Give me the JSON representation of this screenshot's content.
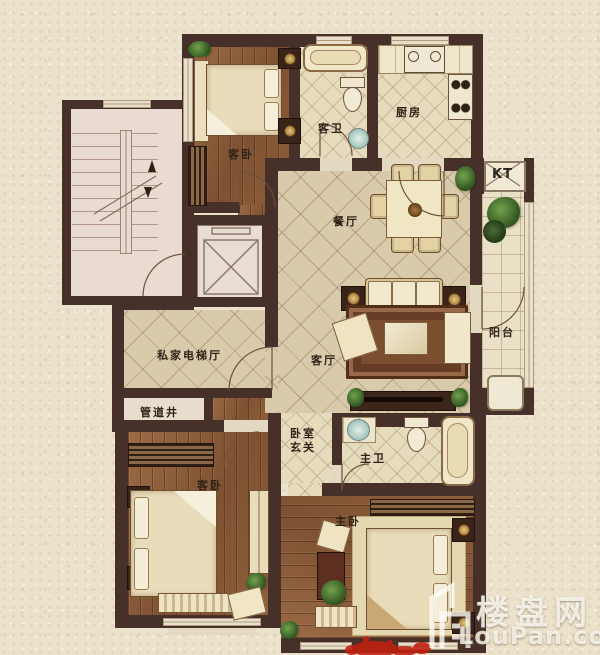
{
  "plan": {
    "rooms": {
      "guest_bedroom_top": {
        "label": "客卧"
      },
      "guest_bathroom": {
        "label": "客卫"
      },
      "kitchen": {
        "label": "厨房"
      },
      "dining_room": {
        "label": "餐厅"
      },
      "living_room": {
        "label": "客厅"
      },
      "ac_platform": {
        "label": "KT"
      },
      "balcony": {
        "label": "阳台"
      },
      "private_elevator_hall": {
        "label": "私家电梯厅"
      },
      "pipe_shaft": {
        "label": "管道井"
      },
      "bedroom_foyer": {
        "label_line1": "卧室",
        "label_line2": "玄关"
      },
      "master_bathroom": {
        "label": "主卫"
      },
      "guest_bedroom_bottom": {
        "label": "客卧"
      },
      "master_bedroom": {
        "label": "主卧"
      }
    }
  },
  "watermark": {
    "brand": "楼盘网",
    "site": "LouPan.com"
  },
  "colors": {
    "wall": "#47302a",
    "background": "#ece2cb",
    "wood_floor": "#91613d",
    "tile_floor": "#d9caab",
    "accent_red": "#c21f10",
    "watermark_white": "#fffdf5"
  }
}
